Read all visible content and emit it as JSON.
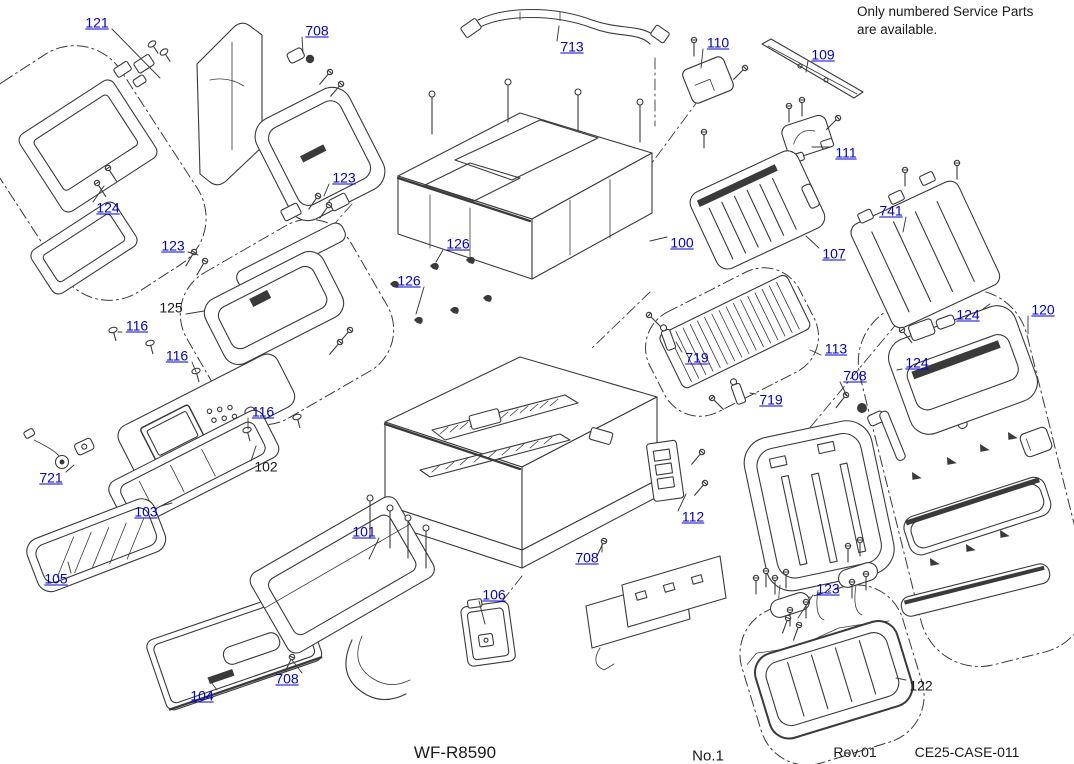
{
  "note": {
    "line1": "Only numbered Service Parts",
    "line2": "are available."
  },
  "footer": {
    "model": "WF-R8590",
    "page_no": "No.1",
    "revision": "Rev.01",
    "doc_code": "CE25-CASE-011"
  },
  "colors": {
    "linked_callout": "#0000cc",
    "plain_callout": "#1a1a1a",
    "diagram_line": "#3a3a3a"
  },
  "callouts": [
    {
      "label": "121",
      "x": 97,
      "y": 23,
      "linked": true,
      "lx": 160,
      "ly": 78
    },
    {
      "label": "708",
      "x": 317,
      "y": 31,
      "linked": true,
      "lx": 303,
      "ly": 53
    },
    {
      "label": "713",
      "x": 572,
      "y": 47,
      "linked": true,
      "lx": 559,
      "ly": 26
    },
    {
      "label": "110",
      "x": 718,
      "y": 43,
      "linked": true,
      "lx": 701,
      "ly": 68
    },
    {
      "label": "109",
      "x": 823,
      "y": 55,
      "linked": true,
      "lx": 806,
      "ly": 72
    },
    {
      "label": "111",
      "x": 846,
      "y": 153,
      "linked": true,
      "lx": 812,
      "ly": 147
    },
    {
      "label": "123",
      "x": 344,
      "y": 178,
      "linked": true,
      "lx": 324,
      "ly": 196
    },
    {
      "label": "123",
      "x": 173,
      "y": 246,
      "linked": true,
      "lx": 198,
      "ly": 255
    },
    {
      "label": "126",
      "x": 458,
      "y": 244,
      "linked": true,
      "lx": 436,
      "ly": 262
    },
    {
      "label": "126",
      "x": 409,
      "y": 281,
      "linked": true,
      "lx": 416,
      "ly": 314
    },
    {
      "label": "100",
      "x": 682,
      "y": 243,
      "linked": true,
      "lx": 650,
      "ly": 241
    },
    {
      "label": "107",
      "x": 834,
      "y": 254,
      "linked": true,
      "lx": 806,
      "ly": 236
    },
    {
      "label": "741",
      "x": 891,
      "y": 211,
      "linked": true,
      "lx": 903,
      "ly": 232
    },
    {
      "label": "124",
      "x": 108,
      "y": 208,
      "linked": true,
      "lx": 104,
      "ly": 186
    },
    {
      "label": "125",
      "x": 171,
      "y": 308,
      "linked": false,
      "lx": 204,
      "ly": 311
    },
    {
      "label": "116",
      "x": 137,
      "y": 326,
      "linked": true,
      "lx": 118,
      "ly": 332
    },
    {
      "label": "116",
      "x": 177,
      "y": 356,
      "linked": true,
      "lx": 196,
      "ly": 372
    },
    {
      "label": "116",
      "x": 263,
      "y": 412,
      "linked": true,
      "lx": 248,
      "ly": 429
    },
    {
      "label": "113",
      "x": 836,
      "y": 349,
      "linked": true,
      "lx": 810,
      "ly": 350
    },
    {
      "label": "719",
      "x": 697,
      "y": 358,
      "linked": true,
      "lx": 676,
      "ly": 342
    },
    {
      "label": "719",
      "x": 771,
      "y": 400,
      "linked": true,
      "lx": 750,
      "ly": 393
    },
    {
      "label": "708",
      "x": 855,
      "y": 376,
      "linked": true,
      "lx": 847,
      "ly": 396
    },
    {
      "label": "124",
      "x": 968,
      "y": 315,
      "linked": true,
      "lx": 990,
      "ly": 304
    },
    {
      "label": "124",
      "x": 917,
      "y": 363,
      "linked": true,
      "lx": 897,
      "ly": 370
    },
    {
      "label": "120",
      "x": 1043,
      "y": 310,
      "linked": true,
      "lx": 1028,
      "ly": 334
    },
    {
      "label": "102",
      "x": 266,
      "y": 467,
      "linked": false,
      "lx": 256,
      "ly": 446
    },
    {
      "label": "721",
      "x": 51,
      "y": 478,
      "linked": true,
      "lx": 74,
      "ly": 465
    },
    {
      "label": "103",
      "x": 146,
      "y": 512,
      "linked": true,
      "lx": 172,
      "ly": 503
    },
    {
      "label": "101",
      "x": 364,
      "y": 532,
      "linked": true,
      "lx": 369,
      "ly": 559
    },
    {
      "label": "105",
      "x": 56,
      "y": 579,
      "linked": true,
      "lx": 68,
      "ly": 562
    },
    {
      "label": "106",
      "x": 494,
      "y": 595,
      "linked": true,
      "lx": 485,
      "ly": 624
    },
    {
      "label": "104",
      "x": 202,
      "y": 696,
      "linked": true,
      "lx": 208,
      "ly": 678
    },
    {
      "label": "708",
      "x": 287,
      "y": 679,
      "linked": true,
      "lx": 292,
      "ly": 660
    },
    {
      "label": "708",
      "x": 587,
      "y": 558,
      "linked": true,
      "lx": 602,
      "ly": 544
    },
    {
      "label": "112",
      "x": 693,
      "y": 517,
      "linked": true,
      "lx": 686,
      "ly": 494
    },
    {
      "label": "123",
      "x": 828,
      "y": 589,
      "linked": true,
      "lx": 798,
      "ly": 618
    },
    {
      "label": "122",
      "x": 921,
      "y": 686,
      "linked": false,
      "lx": 896,
      "ly": 678
    }
  ]
}
